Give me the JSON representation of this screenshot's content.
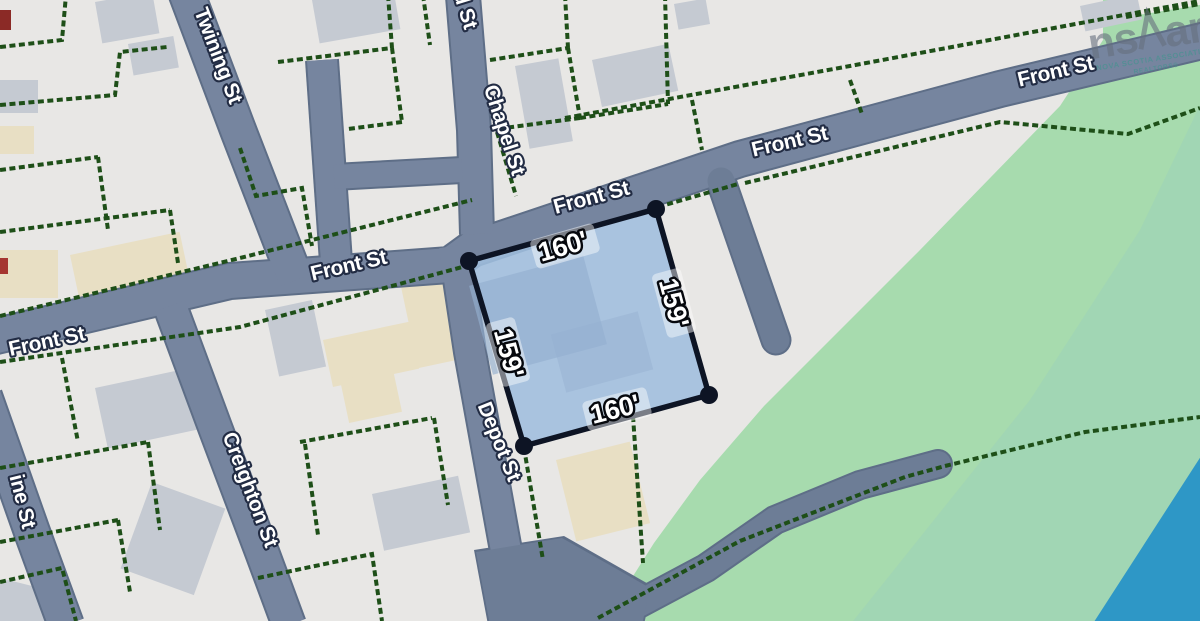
{
  "map": {
    "streets": {
      "front": {
        "label": "Front St"
      },
      "chapel": {
        "label": "Chapel St"
      },
      "depot": {
        "label": "Depot St"
      },
      "creighton": {
        "label": "Creighton St"
      },
      "twining": {
        "label": "Twining St"
      },
      "partial_top": {
        "label": "d St"
      },
      "partial_left": {
        "label": "ine St"
      }
    },
    "parcel": {
      "front_dim": "160'",
      "east_dim": "159'",
      "south_dim": "160'",
      "west_dim": "159'"
    },
    "watermark": {
      "logo_left": "ns",
      "logo_right": "ar",
      "tagline1": "NOVA SCOTIA ASSOCIATION",
      "tagline2": "REALTORS®"
    },
    "colors": {
      "land": "#e8e7e5",
      "green_area": "#a7dbae",
      "teal_area": "#9cd1b9",
      "water": "#2e97c6",
      "street_fill": "#76859f",
      "street_casing": "#5e6e87",
      "parcel_line": "#1e4f18",
      "lot_fill": "#9fbede",
      "lot_border": "#0d1424",
      "building_gray": "#c5cad2",
      "building_beige": "#e8dfc4"
    }
  }
}
